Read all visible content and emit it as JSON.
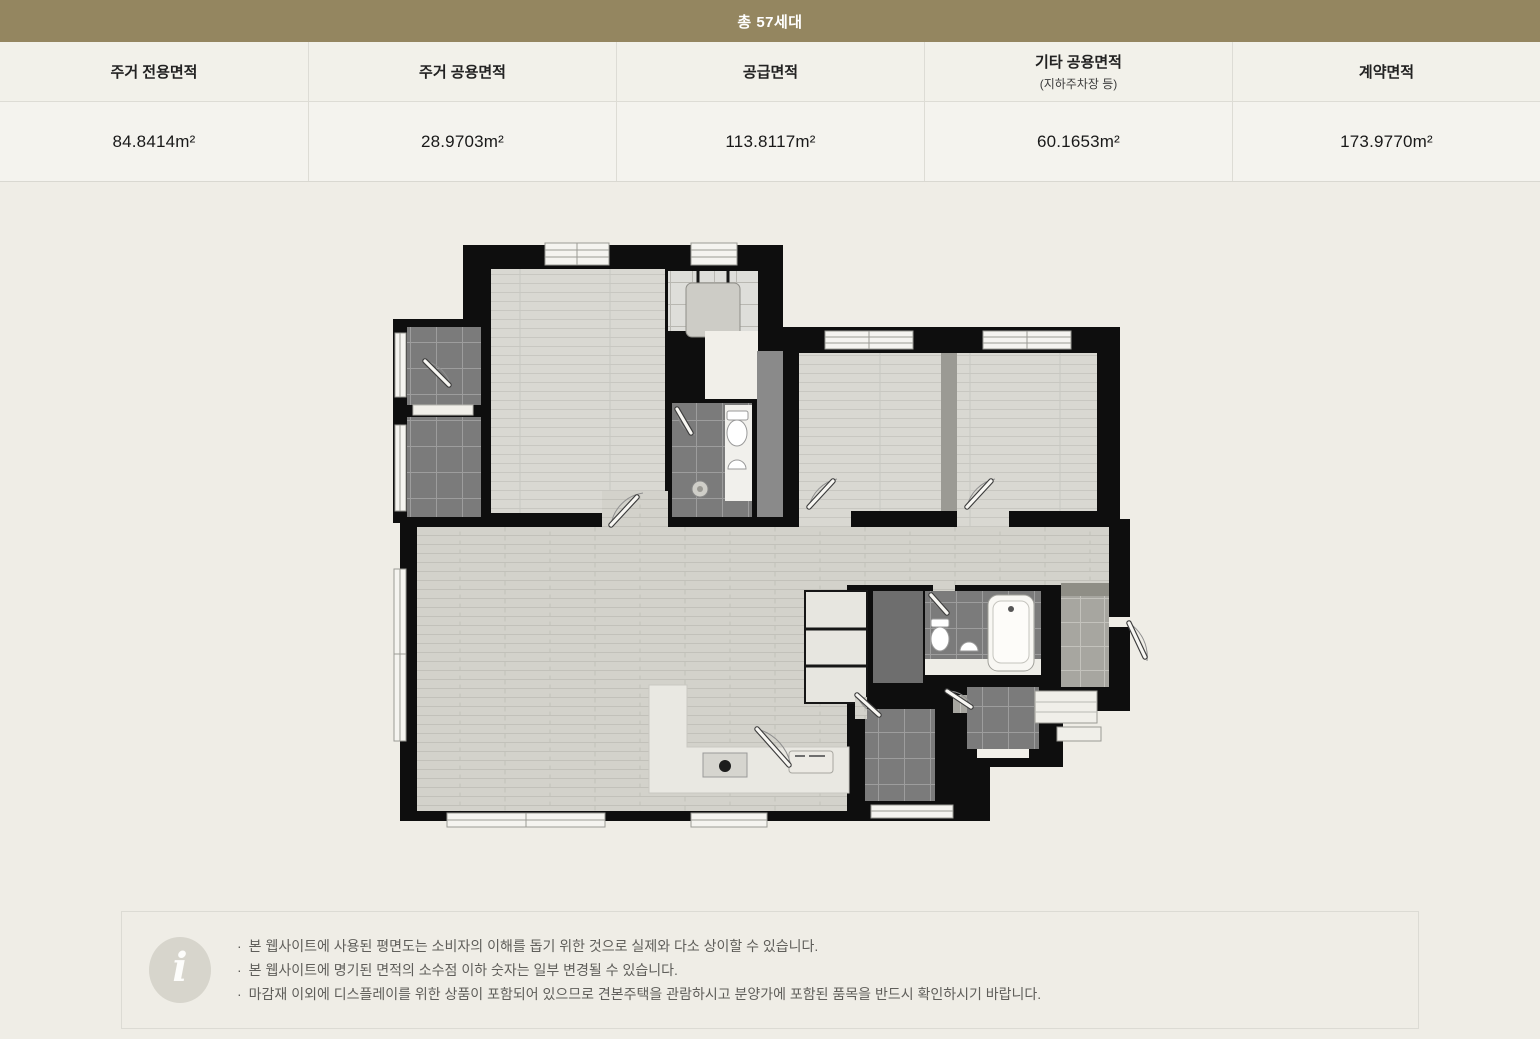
{
  "header": {
    "total_label": "총 57세대"
  },
  "area_table": {
    "columns": [
      {
        "label": "주거 전용면적",
        "sublabel": "",
        "value": "84.8414m²"
      },
      {
        "label": "주거 공용면적",
        "sublabel": "",
        "value": "28.9703m²"
      },
      {
        "label": "공급면적",
        "sublabel": "",
        "value": "113.8117m²"
      },
      {
        "label": "기타 공용면적",
        "sublabel": "(지하주차장 등)",
        "value": "60.1653m²"
      },
      {
        "label": "계약면적",
        "sublabel": "",
        "value": "173.9770m²"
      }
    ]
  },
  "floorplan": {
    "type": "apartment-unit-plan"
  },
  "notice": {
    "icon_glyph": "i",
    "bullet": "·",
    "items": [
      "본 웹사이트에 사용된 평면도는 소비자의 이해를 돕기 위한 것으로 실제와 다소 상이할 수 있습니다.",
      "본 웹사이트에 명기된 면적의 소수점 이하 숫자는 일부 변경될 수 있습니다.",
      "마감재 이외에 디스플레이를 위한 상품이 포함되어 있으므로 견본주택을 관람하시고 분양가에 포함된 품목을 반드시 확인하시기 바랍니다."
    ]
  },
  "colors": {
    "accent_khaki": "#948660",
    "page_bg": "#efede6",
    "table_header_bg": "#f2f1ea",
    "table_value_bg": "#f4f3ee",
    "table_border": "#dddcd5",
    "wall": "#0e0e0e",
    "wood_floor": "#d9d8d2",
    "dark_tile": "#7b7b7b",
    "notice_text": "#5f5e5a"
  }
}
